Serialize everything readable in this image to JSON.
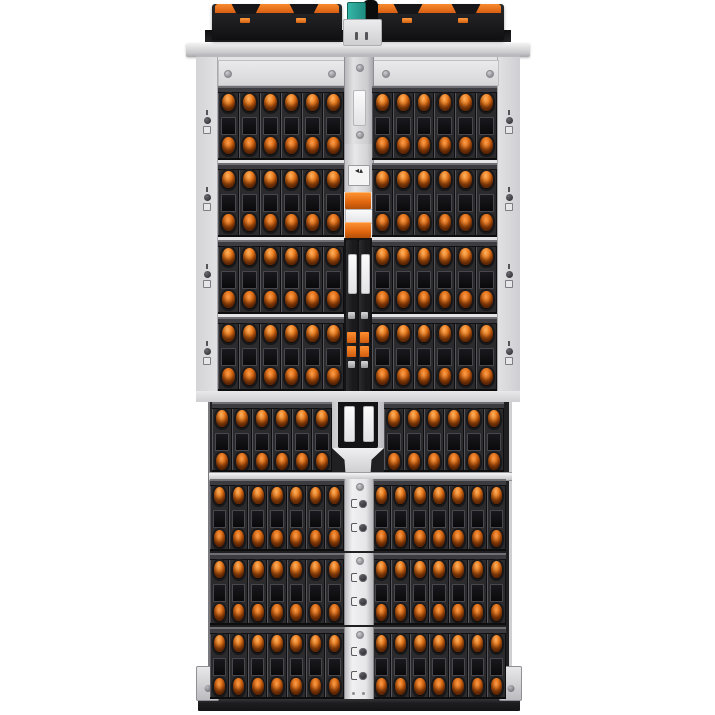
{
  "image": {
    "description": "Top-down product photograph of a high-density rack storage enclosure with hot-swap drive carriers",
    "background": "#ffffff"
  },
  "palette": {
    "latch_orange": "#e8701a",
    "latch_orange_highlight": "#ffb260",
    "latch_orange_shadow": "#7d3406",
    "carrier_dark": "#2b2b2e",
    "label_window_dark": "#0a0a0c",
    "chassis_silver": "#e4e4e6",
    "spine_silver": "#cdcdd0",
    "module_black": "#1c1c1e",
    "connector_teal": "#2aa79b",
    "base_dark": "#1d1d20"
  },
  "layout": {
    "upper_section": {
      "row_count": 4,
      "halves": 2,
      "drives_per_half": 6,
      "total_drives": 48
    },
    "lower_spine_row": {
      "row_count": 1,
      "halves": 2,
      "drives_per_half": 6,
      "total_drives": 12
    },
    "lower_section": {
      "row_count": 3,
      "halves": 2,
      "drives_per_half": 7,
      "total_drives": 42
    },
    "total_drive_slots": 102,
    "top_modules": {
      "count": 2,
      "orange_latches_per_module": 2
    },
    "controller_modules_in_spine": 2
  },
  "icons": {
    "rail_indicator": "lock-status-indicator",
    "strip_indicator": "release-button-indicator",
    "screw": "screw-head",
    "warning": "caution-label",
    "plug": "teal-connector",
    "cable": "power-cable"
  },
  "labels": {
    "spine_service_label": "",
    "controller_label": "",
    "caution_glyphs": "◂▴"
  }
}
